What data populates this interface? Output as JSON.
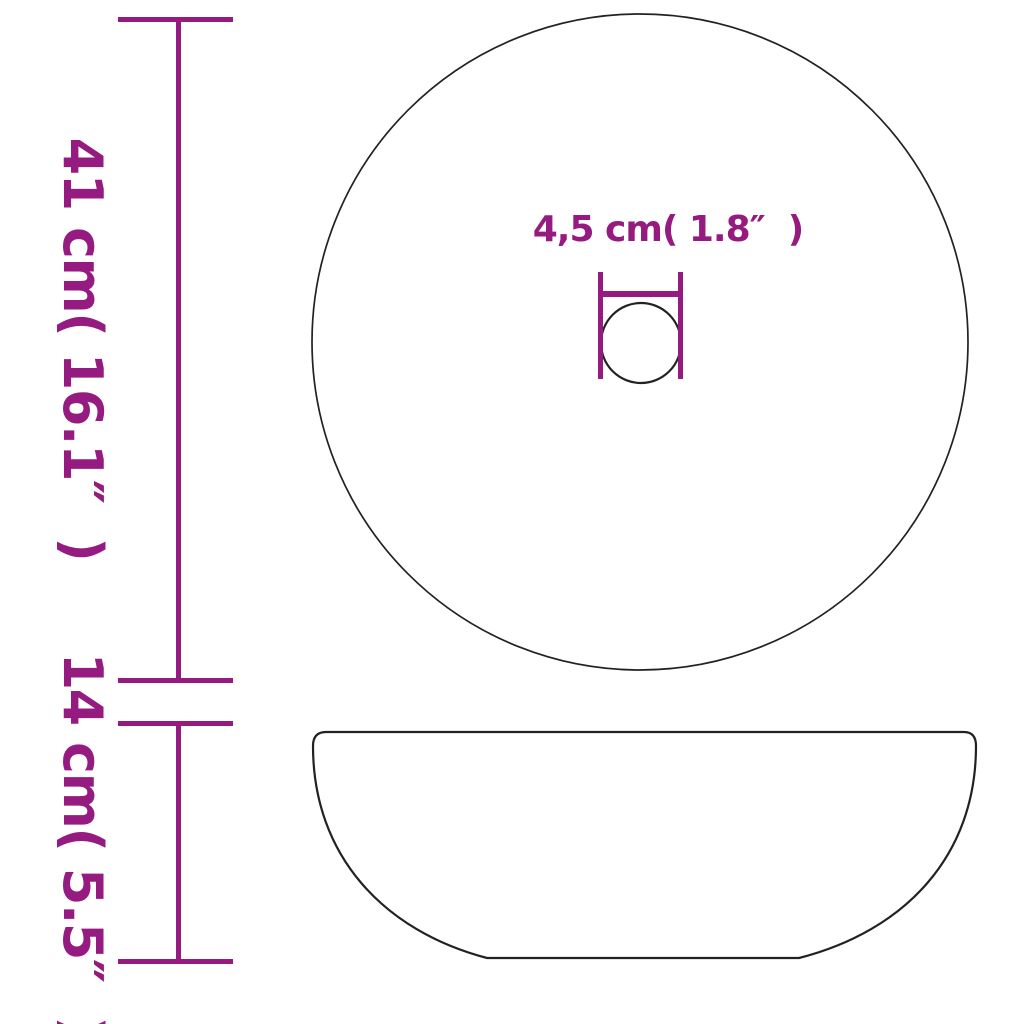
{
  "colors": {
    "background": "#ffffff",
    "accent": "#951b81",
    "outline": "#222222"
  },
  "diagram": {
    "kind": "product-dimension-drawing",
    "subject": "round-washbasin",
    "views": {
      "top_view": "circle-with-drain-hole",
      "side_view": "bowl-profile"
    }
  },
  "dimensions": {
    "diameter": {
      "metric": "41 cm",
      "imperial": "16.1″",
      "label": "41 cm( 16.1″  )"
    },
    "height": {
      "metric": "14 cm",
      "imperial": "5.5″",
      "label": "14 cm( 5.5″  )"
    },
    "drain_hole": {
      "metric": "4,5 cm",
      "imperial": "1.8″",
      "label": "4,5 cm( 1.8″  )"
    }
  }
}
